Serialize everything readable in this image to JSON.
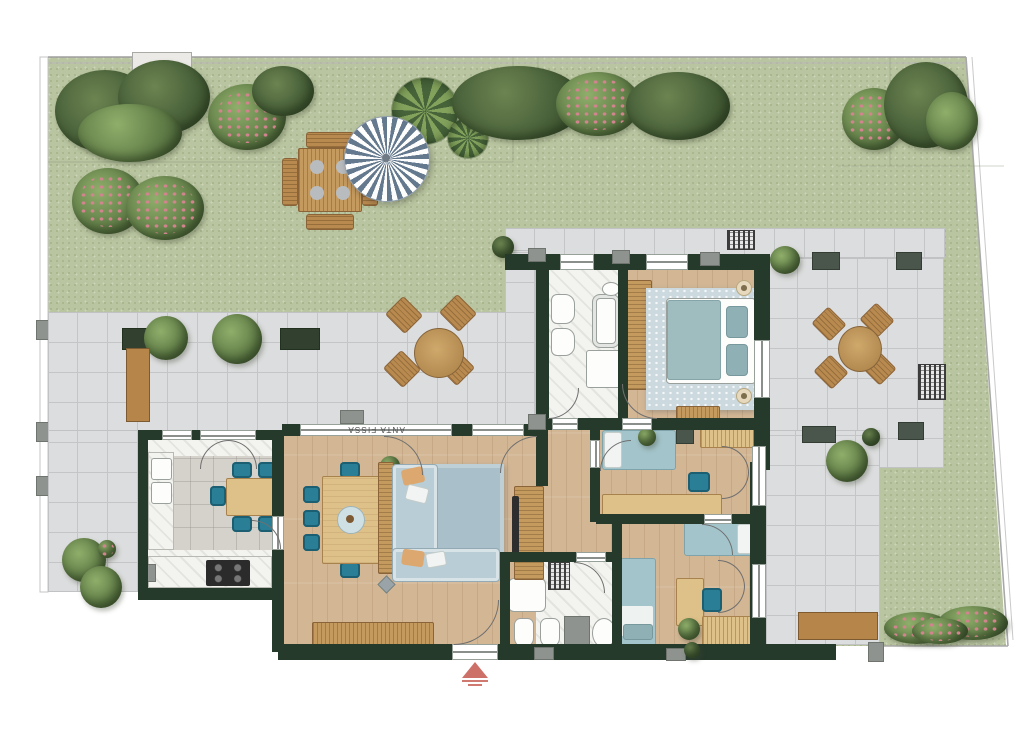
{
  "document": {
    "type": "residential-floor-plan-rendering",
    "view": "top-down",
    "orientation_marker": "entrance-arrow"
  },
  "labels": {
    "fixed_window_panel": "ANTA FISSA"
  },
  "icons": {
    "entrance_marker": "red-plan-arrow",
    "roof_vent": "hatched-grate",
    "skylight": "dark-rectangle"
  },
  "colors": {
    "wall": "#263a2c",
    "grass": "#b9c5a0",
    "grass_dot": "#a6b289",
    "terrace": "#dcddde",
    "terrace_line": "#c3c5c7",
    "wood_floor": "#d3b795",
    "marble": "#f3f3f0",
    "kitchen_tile": "#d5d1cb",
    "foliage_dark": "#3f5531",
    "foliage_mid": "#5f7b46",
    "foliage_light": "#8fae6a",
    "flower_pink": "#d2848e",
    "teal": "#2a7f97",
    "sofa": "#b9cdd6",
    "rug": "#a9bfc9",
    "bed_blue": "#a3c4ca",
    "wood_furn": "#c59a5f",
    "wood_light": "#dec089",
    "bench": "#b5854a",
    "parasol": "#64788e",
    "marker_red": "#c4574e",
    "fixture_line": "#9aa09b",
    "gray_stub": "#8e938f"
  },
  "scene": {
    "outdoor": [
      "garden-lawn",
      "hedges",
      "flower-bushes",
      "garden-dining-set",
      "parasol",
      "terraces",
      "benches",
      "planters",
      "terrace-dining-sets",
      "flower-bed"
    ],
    "rooms": [
      "master-bathroom",
      "master-bedroom",
      "hallway",
      "bedroom-2",
      "bedroom-3",
      "second-bathroom",
      "kitchen",
      "living-dining-room"
    ],
    "furniture": [
      "double-bed",
      "single-beds",
      "wardrobes",
      "desks",
      "l-shaped-sofa",
      "rugs",
      "dining-table-8-chairs",
      "kitchen-table-5-chairs",
      "sideboard",
      "tv-unit",
      "bathtub",
      "showers",
      "toilets",
      "bidets",
      "washing-machine",
      "cooktop",
      "double-sink"
    ]
  }
}
